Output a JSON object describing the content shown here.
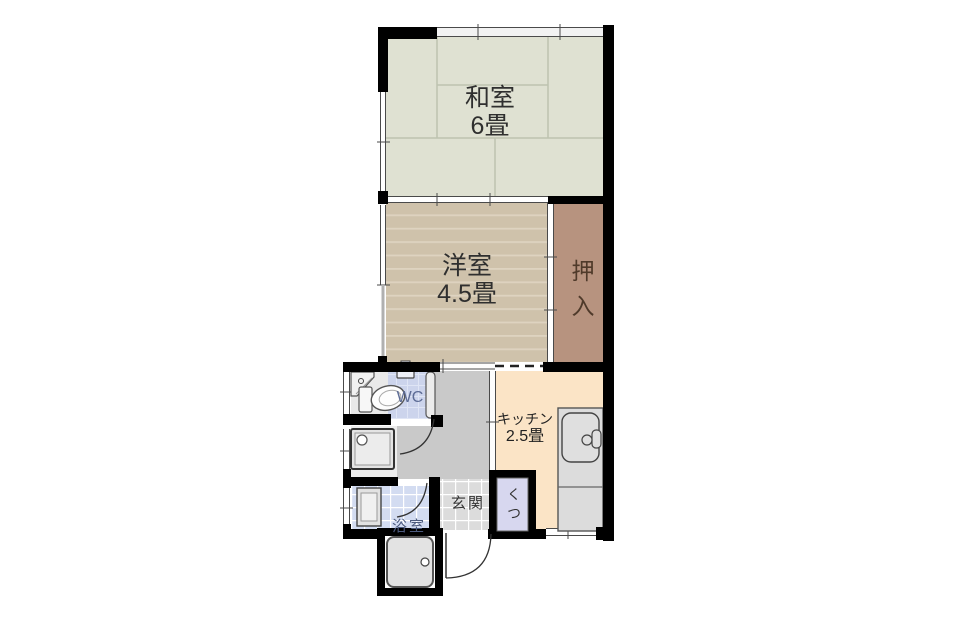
{
  "page": {
    "type": "apartment-floor-plan",
    "background": "#ffffff"
  },
  "rooms": {
    "washitsu": {
      "name": "和室",
      "size": "6畳"
    },
    "youshitsu": {
      "name": "洋室",
      "size": "4.5畳"
    },
    "oshiire": {
      "name": "押入"
    },
    "kitchen": {
      "name": "キッチン",
      "size": "2.5畳"
    },
    "wc": {
      "name": "WC"
    },
    "genkan": {
      "name": "玄関"
    },
    "shoebox": {
      "name": "くつ"
    },
    "bathroom": {
      "name": "浴室"
    }
  },
  "colors": {
    "wall": "#000000",
    "tatami_floor": "#dfe1d2",
    "tatami_line": "#bdc3b0",
    "wood_floor": "#cfc2ab",
    "wood_line": "#ded3c0",
    "closet_floor": "#b7937f",
    "kitchen_floor": "#fbe4c6",
    "wc_floor": "#ccd4ec",
    "hallway_floor": "#c9c9c9",
    "genkan_tile": "#dcdcdc",
    "bath_tile": "#d3dcf1",
    "shoebox_fill": "#d7d7ef",
    "fixture_fill": "#e3e3e3",
    "closet_text": "#4f3a2a",
    "wc_text": "#5d6c95",
    "bath_text": "#4c5a7d"
  }
}
